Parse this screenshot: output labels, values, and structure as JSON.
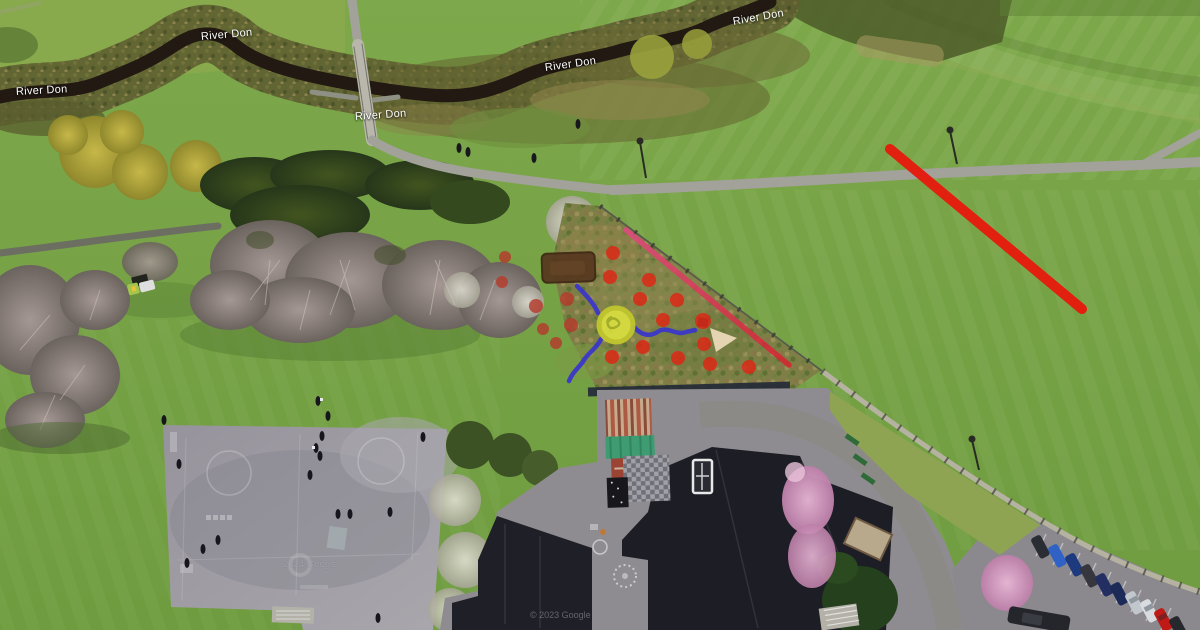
{
  "map_labels": [
    {
      "text": "River Don",
      "x": 16,
      "y": 86,
      "rot": -3
    },
    {
      "text": "River Don",
      "x": 201,
      "y": 31,
      "rot": -5
    },
    {
      "text": "River Don",
      "x": 355,
      "y": 111,
      "rot": -4
    },
    {
      "text": "River Don",
      "x": 545,
      "y": 62,
      "rot": -8
    },
    {
      "text": "River Don",
      "x": 733,
      "y": 16,
      "rot": -10
    }
  ],
  "watermarks": {
    "center": "2024 Google",
    "bottom": "© 2023 Google"
  },
  "palette": {
    "grass": "#75a245",
    "water": "#201812",
    "path_gray": "#a2a29a",
    "tarmac": "#9b98a0",
    "roof_dark": "#1e1e26",
    "annotation_red_bright": "#df2513",
    "annotation_red_muted": "#b43a2c",
    "annotation_blue": "#3a34cd",
    "annotation_yellow": "#dce23f",
    "annotation_brown": "#56371e",
    "annotation_pink": "#e24a80",
    "annotation_crimson": "#d8222f",
    "long_red": "#e7190d"
  },
  "annotations": {
    "red_dots": [
      {
        "x": 613,
        "y": 253,
        "r": 7,
        "bright": 1
      },
      {
        "x": 610,
        "y": 277,
        "r": 7,
        "bright": 1
      },
      {
        "x": 649,
        "y": 280,
        "r": 7,
        "bright": 1
      },
      {
        "x": 505,
        "y": 257,
        "r": 6,
        "bright": 0
      },
      {
        "x": 502,
        "y": 282,
        "r": 6,
        "bright": 0
      },
      {
        "x": 536,
        "y": 306,
        "r": 7,
        "bright": 0
      },
      {
        "x": 567,
        "y": 299,
        "r": 7,
        "bright": 0
      },
      {
        "x": 640,
        "y": 299,
        "r": 7,
        "bright": 1
      },
      {
        "x": 677,
        "y": 300,
        "r": 7,
        "bright": 1
      },
      {
        "x": 543,
        "y": 329,
        "r": 6,
        "bright": 0
      },
      {
        "x": 571,
        "y": 325,
        "r": 7,
        "bright": 0
      },
      {
        "x": 663,
        "y": 320,
        "r": 7,
        "bright": 1
      },
      {
        "x": 703,
        "y": 321,
        "r": 8,
        "bright": 1
      },
      {
        "x": 556,
        "y": 343,
        "r": 6,
        "bright": 0
      },
      {
        "x": 643,
        "y": 347,
        "r": 7,
        "bright": 1
      },
      {
        "x": 704,
        "y": 344,
        "r": 7,
        "bright": 1
      },
      {
        "x": 612,
        "y": 357,
        "r": 7,
        "bright": 1
      },
      {
        "x": 678,
        "y": 358,
        "r": 7,
        "bright": 1
      },
      {
        "x": 710,
        "y": 364,
        "r": 7,
        "bright": 1
      },
      {
        "x": 749,
        "y": 367,
        "r": 7,
        "bright": 1
      }
    ],
    "yellow_circle": {
      "x": 616,
      "y": 325,
      "r_outer": 17,
      "fill": "#dce23f",
      "ring": "#c4ca2c",
      "scribble": "#99a326"
    },
    "blue_paths": [
      "M 577,286 C 584,293 594,303 598,313",
      "M 634,327 C 642,336 651,337 659,331 C 667,326 677,336 686,332 L 695,330",
      "M 601,339 C 597,348 589,352 584,360 C 579,368 573,371 569,381"
    ],
    "brown_rect": {
      "x": 542,
      "y": 253,
      "w": 53,
      "h": 29,
      "rx": 5,
      "rot": -2
    },
    "fence_line": {
      "x1": 626,
      "y1": 230,
      "x2": 789,
      "y2": 365,
      "w": 5.5
    },
    "long_red_line": {
      "x1": 890,
      "y1": 149,
      "x2": 1082,
      "y2": 309,
      "w": 10
    }
  }
}
